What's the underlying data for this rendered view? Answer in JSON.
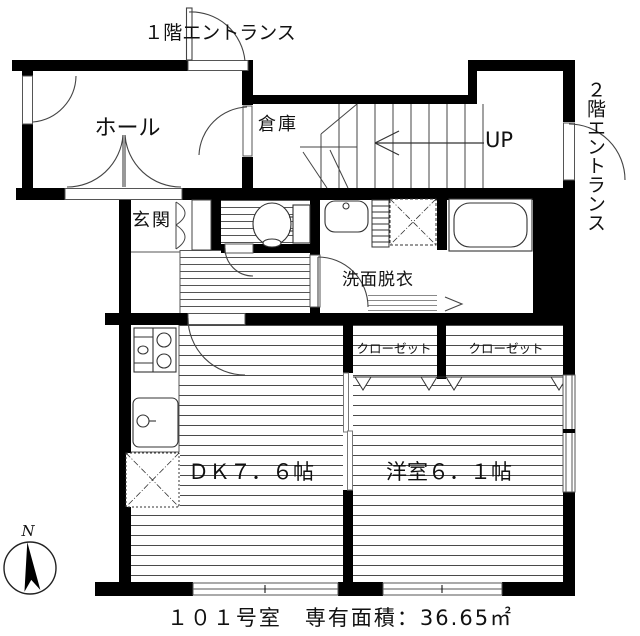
{
  "floorplan": {
    "caption": "１０１号室　専有面積：36.65㎡",
    "labels": {
      "entrance_1f": "１階エントランス",
      "entrance_2f": "２階エントランス",
      "hall": "ホール",
      "storage": "倉庫",
      "stairs_up": "UP",
      "genkan": "玄関",
      "washroom": "洗面脱衣",
      "closet_left": "クローゼット",
      "closet_right": "クローゼット",
      "dining_kitchen": "ＤＫ７．６帖",
      "western_room": "洋室６．１帖"
    },
    "rooms": {
      "dining_kitchen_size_tatami": "7.6",
      "western_room_size_tatami": "6.1",
      "unit_number": "１０１号室",
      "exclusive_area_sqm": "36.65"
    },
    "compass": {
      "north": "N"
    },
    "colors": {
      "wall": "#000000",
      "line": "#333333",
      "stripe": "#777777",
      "background": "#ffffff"
    }
  }
}
